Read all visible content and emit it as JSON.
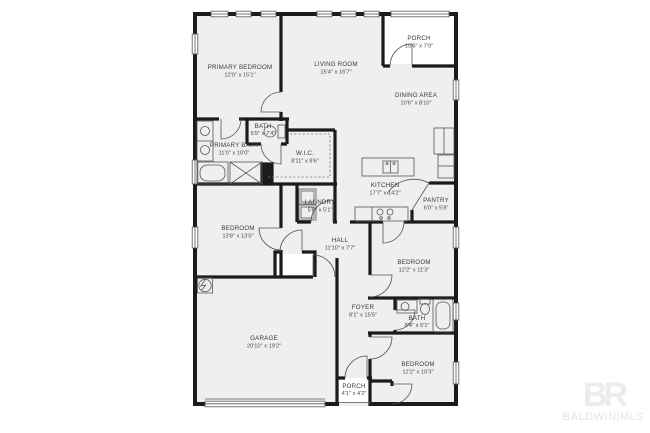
{
  "plan": {
    "rooms": [
      {
        "name": "PRIMARY BEDROOM",
        "dims": "12'0\" x 15'1\""
      },
      {
        "name": "LIVING ROOM",
        "dims": "15'4\" x 16'7\""
      },
      {
        "name": "PORCH",
        "dims": "10'6\" x 7'9\""
      },
      {
        "name": "DINING AREA",
        "dims": "10'6\" x 8'10\""
      },
      {
        "name": "BATH",
        "dims": "5'9\" x 7'4\""
      },
      {
        "name": "PRIMARY BATH",
        "dims": "11'0\" x 10'0\""
      },
      {
        "name": "W.I.C.",
        "dims": "8'11\" x 8'6\""
      },
      {
        "name": "KITCHEN",
        "dims": "17'7\" x 14'2\""
      },
      {
        "name": "PANTRY",
        "dims": "6'0\" x 5'8\""
      },
      {
        "name": "LAUNDRY",
        "dims": "5'8\" x 5'1\""
      },
      {
        "name": "BEDROOM",
        "dims": "13'8\" x 13'0\""
      },
      {
        "name": "HALL",
        "dims": "11'10\" x 7'7\""
      },
      {
        "name": "BEDROOM",
        "dims": "12'2\" x 11'3\""
      },
      {
        "name": "FOYER",
        "dims": "8'1\" x 15'5\""
      },
      {
        "name": "BATH",
        "dims": "8'4\" x 5'1\""
      },
      {
        "name": "GARAGE",
        "dims": "20'10\" x 19'2\""
      },
      {
        "name": "BEDROOM",
        "dims": "12'2\" x 10'3\""
      },
      {
        "name": "PORCH",
        "dims": "4'1\" x 4'2\""
      }
    ],
    "watermark": {
      "logo": "BR",
      "label": "BALDWIN|MLS"
    },
    "colors": {
      "wall": "#1b1b1b",
      "room_fill": "#efefef",
      "line": "#555555",
      "label": "#3a3a3a",
      "watermark": "#ececec"
    }
  }
}
